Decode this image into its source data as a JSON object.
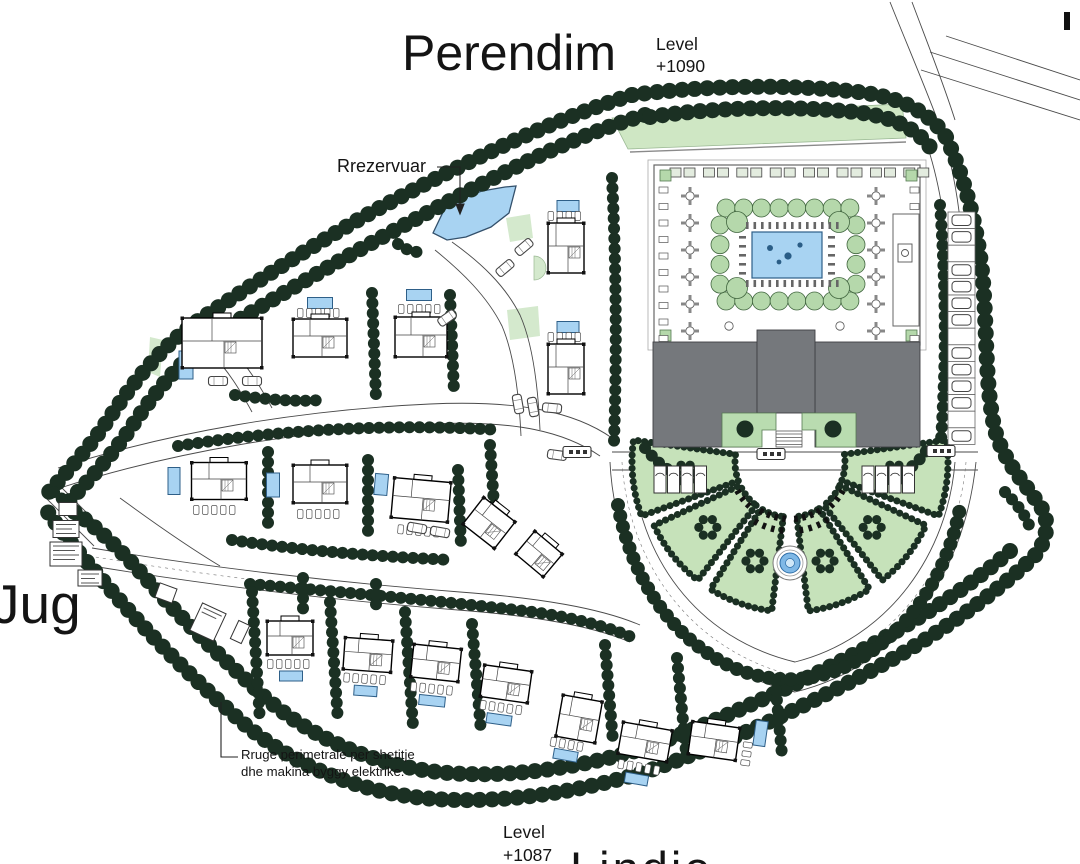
{
  "title_labels": {
    "perendim": "Perendim",
    "level_top_line1": "Level",
    "level_top_line2": "+1090",
    "rrezervuar": "Rrezervuar",
    "jug": "Jug",
    "level_bottom_line1": "Level",
    "level_bottom_line2": "+1087",
    "lindje": "Lindje",
    "note_line1": "Rruge perimetrale per shetitje",
    "note_line2": "dhe makina byggy elektrike."
  },
  "colors": {
    "tree_dark_green": "#1b3023",
    "lawn_green": "#cfe7c4",
    "courtyard_tree_green": "#b5d8ab",
    "wedge_green": "#c6e2ba",
    "pool_blue": "#a8d3f2",
    "fountain_blue": "#7fb8e6",
    "building_gray": "#75787c",
    "line_gray": "#4a4a4a"
  },
  "plan": {
    "villas": [
      {
        "x": 222,
        "y": 343,
        "w": 80,
        "h": 50,
        "a": 0,
        "pool": [
          -36,
          22,
          14,
          28
        ],
        "chairs": [
          -22,
          8,
          4,
          "v"
        ]
      },
      {
        "x": 320,
        "y": 338,
        "w": 54,
        "h": 38,
        "a": 0,
        "pool": [
          0,
          -35,
          25,
          11
        ],
        "chairs": [
          0,
          -25,
          5,
          "h"
        ]
      },
      {
        "x": 421,
        "y": 337,
        "w": 52,
        "h": 40,
        "a": 0,
        "pool": [
          -2,
          -42,
          25,
          11
        ],
        "chairs": [
          0,
          -28,
          5,
          "h"
        ]
      },
      {
        "x": 566,
        "y": 248,
        "w": 36,
        "h": 50,
        "a": 0,
        "pool": [
          2,
          -42,
          22,
          11
        ],
        "chairs": [
          0,
          -32,
          4,
          "h"
        ]
      },
      {
        "x": 566,
        "y": 369,
        "w": 36,
        "h": 50,
        "a": 0,
        "pool": [
          2,
          -42,
          22,
          11
        ],
        "chairs": [
          0,
          -32,
          4,
          "h"
        ]
      },
      {
        "x": 219,
        "y": 481,
        "w": 55,
        "h": 37,
        "a": 0,
        "pool": [
          -45,
          0,
          12,
          27
        ],
        "chairs": [
          -3,
          29,
          5,
          "h"
        ]
      },
      {
        "x": 320,
        "y": 484,
        "w": 54,
        "h": 38,
        "a": 0,
        "pool": [
          -47,
          1,
          13,
          24
        ],
        "chairs": [
          0,
          30,
          5,
          "h"
        ]
      },
      {
        "x": 421,
        "y": 500,
        "w": 57,
        "h": 40,
        "a": 5,
        "pool": [
          -41,
          -12,
          13,
          21
        ],
        "chairs": [
          2,
          31,
          5,
          "h"
        ]
      },
      {
        "x": 489,
        "y": 523,
        "w": 40,
        "h": 34,
        "a": 38,
        "pool": null,
        "chairs": null
      },
      {
        "x": 539,
        "y": 554,
        "w": 36,
        "h": 30,
        "a": 40,
        "pool": null,
        "chairs": null
      },
      {
        "x": 290,
        "y": 638,
        "w": 46,
        "h": 34,
        "a": 0,
        "pool": [
          1,
          38,
          23,
          10
        ],
        "chairs": [
          0,
          26,
          5,
          "h"
        ]
      },
      {
        "x": 368,
        "y": 655,
        "w": 48,
        "h": 32,
        "a": 4,
        "pool": [
          0,
          36,
          23,
          10
        ],
        "chairs": [
          0,
          24,
          5,
          "h"
        ]
      },
      {
        "x": 436,
        "y": 663,
        "w": 48,
        "h": 33,
        "a": 6,
        "pool": [
          0,
          38,
          26,
          10
        ],
        "chairs": [
          0,
          26,
          5,
          "h"
        ]
      },
      {
        "x": 506,
        "y": 684,
        "w": 48,
        "h": 32,
        "a": 8,
        "pool": [
          -2,
          36,
          25,
          10
        ],
        "chairs": [
          0,
          24,
          5,
          "h"
        ]
      },
      {
        "x": 579,
        "y": 719,
        "w": 40,
        "h": 42,
        "a": 10,
        "pool": [
          -7,
          38,
          24,
          10
        ],
        "chairs": [
          -6,
          27,
          4,
          "h"
        ]
      },
      {
        "x": 645,
        "y": 742,
        "w": 50,
        "h": 32,
        "a": 10,
        "pool": [
          -2,
          38,
          23,
          10
        ],
        "chairs": [
          0,
          26,
          5,
          "h"
        ]
      },
      {
        "x": 714,
        "y": 741,
        "w": 48,
        "h": 33,
        "a": 8,
        "pool": [
          45,
          -14,
          12,
          25
        ],
        "chairs": [
          34,
          10,
          3,
          "v"
        ]
      }
    ],
    "cars": [
      [
        218,
        381,
        0
      ],
      [
        252,
        381,
        0
      ],
      [
        524,
        247,
        -40
      ],
      [
        505,
        268,
        -40
      ],
      [
        447,
        318,
        -35
      ],
      [
        518,
        404,
        80
      ],
      [
        533,
        407,
        80
      ],
      [
        552,
        408,
        5
      ],
      [
        417,
        528,
        10
      ],
      [
        440,
        532,
        10
      ],
      [
        557,
        455,
        8
      ]
    ],
    "buses": [
      [
        771,
        454
      ],
      [
        941,
        451
      ],
      [
        577,
        452
      ]
    ],
    "small_buildings": [
      [
        68,
        509,
        18,
        13,
        0,
        0
      ],
      [
        66,
        529,
        26,
        17,
        0,
        3
      ],
      [
        66,
        554,
        32,
        24,
        0,
        4
      ],
      [
        90,
        578,
        24,
        16,
        0,
        3
      ],
      [
        166,
        593,
        18,
        15,
        20,
        0
      ],
      [
        208,
        622,
        26,
        30,
        25,
        2
      ],
      [
        240,
        632,
        12,
        20,
        25,
        0
      ]
    ],
    "parking_right": {
      "x": 948,
      "y": 212,
      "count": 14,
      "w": 27,
      "h": 16.6,
      "empty": [
        2,
        7,
        12
      ]
    }
  }
}
